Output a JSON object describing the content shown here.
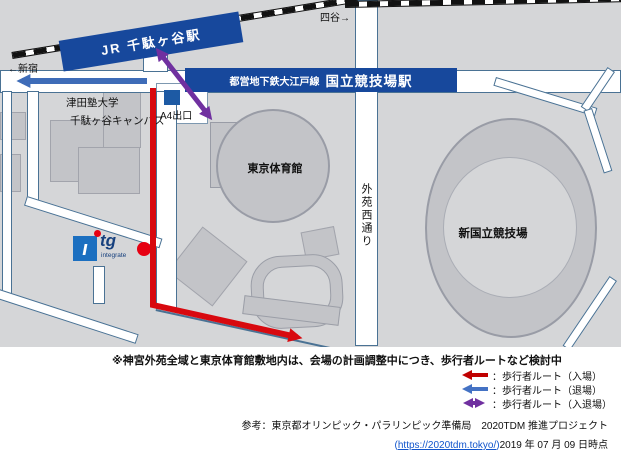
{
  "map": {
    "railway": {
      "jr_station_label": "JR 千駄ヶ谷駅",
      "to_shinjuku": "←新宿",
      "to_yotsuya": "四谷→"
    },
    "subway": {
      "line_label": "都営地下鉄大江戸線",
      "station_label": "国立競技場駅",
      "exit_label": "A4出口"
    },
    "places": {
      "university_line1": "津田塾大学",
      "university_line2": "千駄ヶ谷キャンパス",
      "gymnasium": "東京体育館",
      "stadium": "新国立競技場",
      "road_name": "外苑西通り"
    },
    "logo": {
      "letter_i": "ı",
      "letters_tg": "tg",
      "subtext": "integrate"
    }
  },
  "note": "※神宮外苑全域と東京体育館敷地内は、会場の計画調整中につき、歩行者ルートなど検討中",
  "legend": {
    "items": [
      {
        "label": "：歩行者ルート（入場）",
        "color": "#c00000",
        "arrow": "left"
      },
      {
        "label": "：歩行者ルート（退場）",
        "color": "#4472c4",
        "arrow": "left"
      },
      {
        "label": "：歩行者ルート（入退場）",
        "color": "#7030a0",
        "arrow": "double"
      }
    ]
  },
  "reference": {
    "credit": "参考：東京都オリンピック・パラリンピック準備局　2020TDM 推進プロジェクト",
    "open_paren": "(",
    "url": "https://2020tdm.tokyo/",
    "close_paren": ")",
    "date": "2019 年 07 月 09 日時点"
  },
  "colors": {
    "navy": "#17489c",
    "route_enter_red": "#d8090f",
    "route_exit_blue": "#3e6cb8",
    "route_both_purple": "#7030a0",
    "map_bg": "#d5d6d8",
    "building_gray": "#c3c4c8",
    "location_marker_red": "#e60012",
    "logo_blue": "#1b6fc0"
  }
}
